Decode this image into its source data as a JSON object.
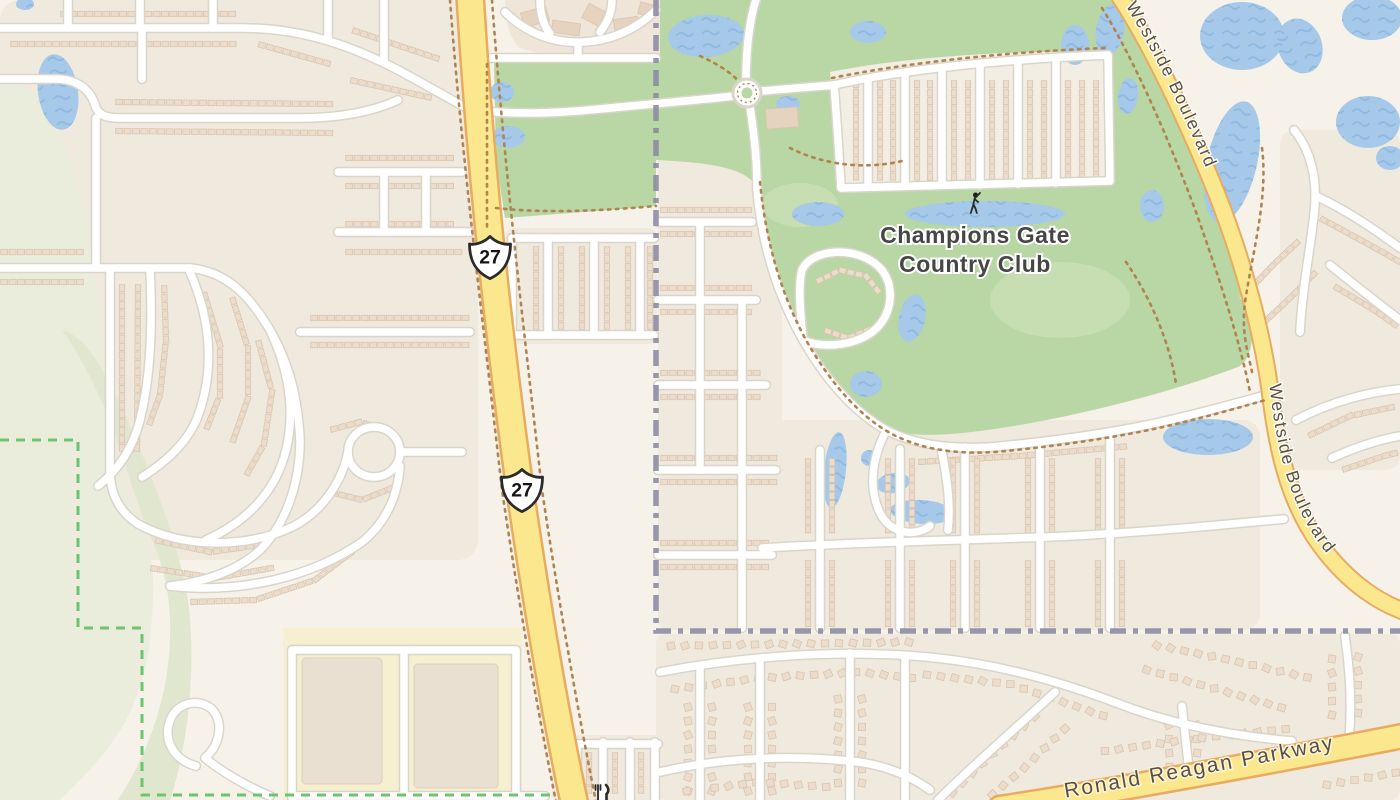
{
  "map": {
    "type": "street-map",
    "labels": {
      "club_line1": "Champions Gate",
      "club_line2": "Country Club",
      "westside_boulevard": "Westside Boulevard",
      "ronald_reagan_parkway": "Ronald Reagan Parkway",
      "route_shield": "27"
    },
    "icons": {
      "golfer": "golfer-icon",
      "restaurant": "restaurant-icon"
    },
    "colors": {
      "background": "#f6f2e9",
      "residential": "#f0e9dd",
      "natural": "#eaeddc",
      "natural_dark": "#e1e7cf",
      "golf": "#b8d7a4",
      "golf_light": "#c6deb1",
      "water": "#a6c9ea",
      "wave": "#8fb9df",
      "road": "#ffffff",
      "road_casing": "#dad5cb",
      "hwy": "#fbe88e",
      "hwy_casing": "#e8ab60",
      "building": "#ebdccb",
      "building_stroke": "#d9c5af",
      "building2": "#e5d2bf",
      "retail": "#f6efd0",
      "retail_building": "#e9e0d1",
      "boundary": "#8d8ca4",
      "protected": "#6cc46c",
      "treerow": "#b0834f",
      "label": "#464646",
      "road_label": "#584f43"
    }
  }
}
